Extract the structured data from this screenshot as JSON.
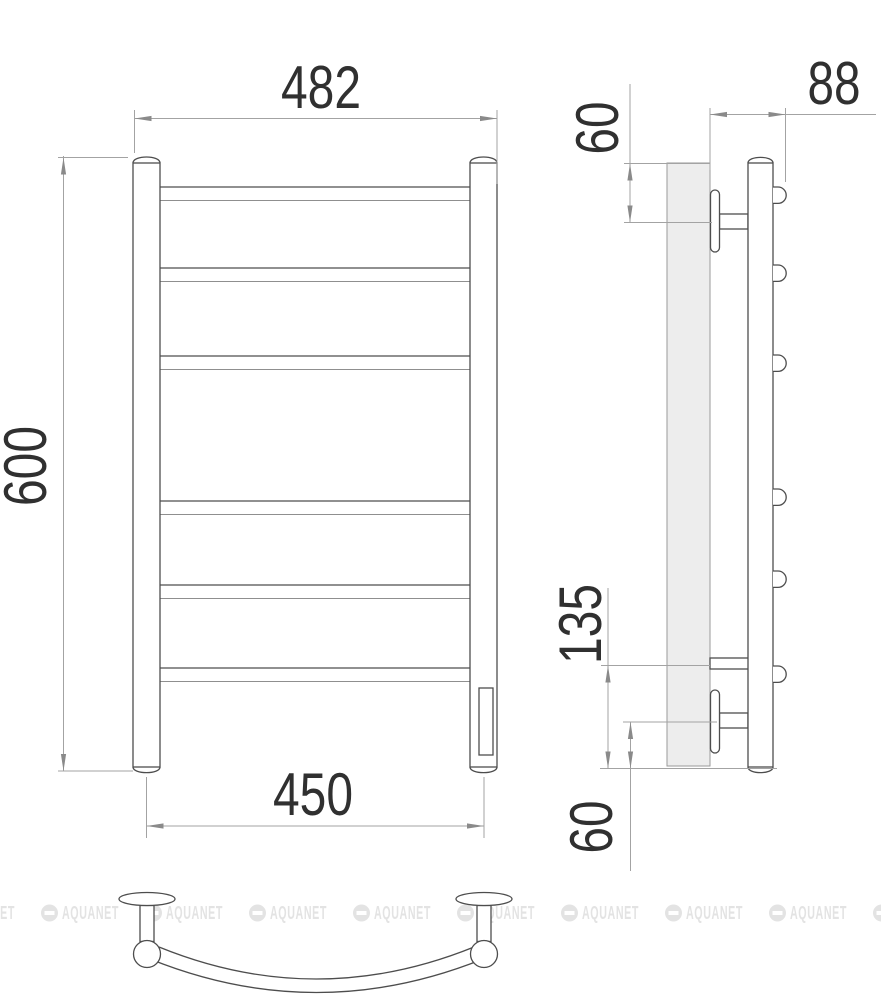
{
  "dimensions": {
    "front_top_width": "482",
    "front_height": "600",
    "front_bottom_width": "450",
    "side_depth": "88",
    "side_top_offset": "60",
    "side_lower_span": "135",
    "side_bottom_offset": "60"
  },
  "watermark": {
    "text": "AQUANET",
    "count": 10,
    "color": "#e3e3e3"
  },
  "colors": {
    "object_line": "#4d4d4d",
    "dimension_line": "#a3a3a3",
    "label_text": "#303030",
    "wall_plate_fill": "#ededed",
    "background": "#ffffff"
  }
}
